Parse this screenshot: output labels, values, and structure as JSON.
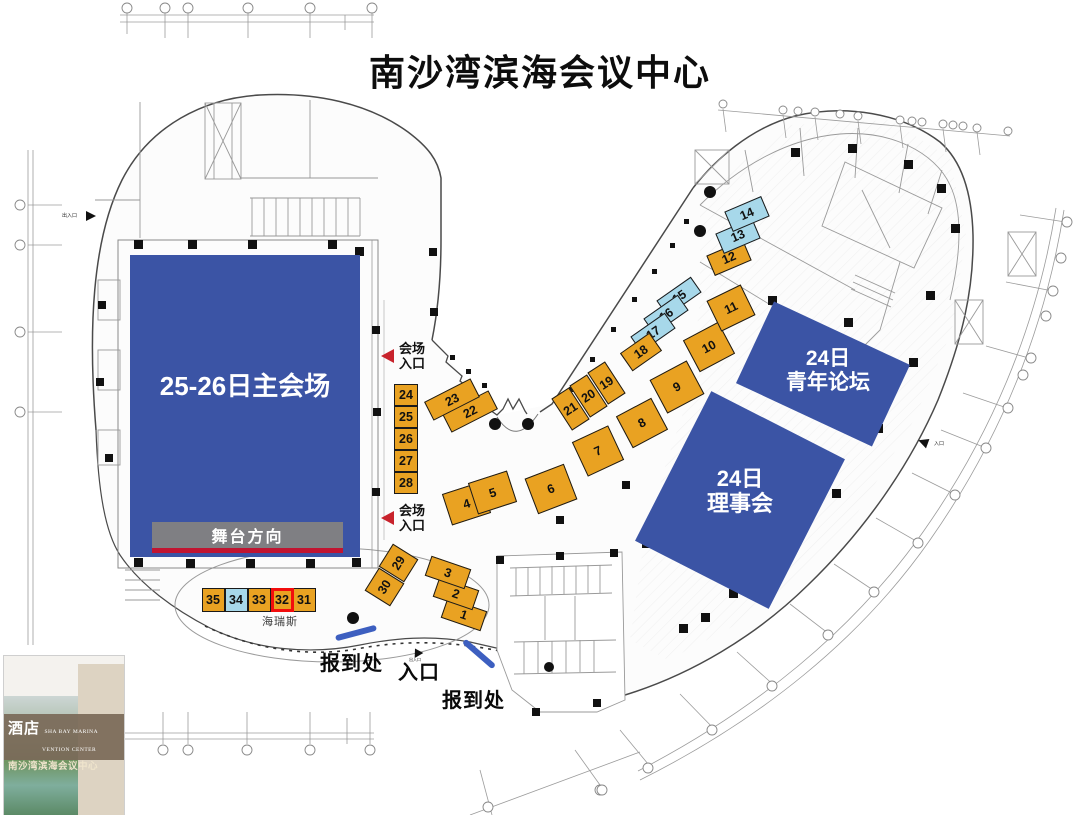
{
  "title": "南沙湾滨海会议中心",
  "colors": {
    "hall_blue": "#3B54A5",
    "booth_orange": "#E9A222",
    "booth_lightblue": "#A7D8EA",
    "stage_gray": "#7F7F83",
    "stage_red": "#C11431",
    "marker_red": "#C8232C",
    "highlight_red": "#F20D0D",
    "desk_blue": "#3D5FC0"
  },
  "halls": {
    "main": {
      "label": "25-26日主会场"
    },
    "stage": {
      "label": "舞台方向"
    },
    "youth_forum": {
      "line1": "24日",
      "line2": "青年论坛"
    },
    "council": {
      "line1": "24日",
      "line2": "理事会"
    }
  },
  "entrances": {
    "hall_entrance_upper": {
      "line1": "会场",
      "line2": "入口"
    },
    "hall_entrance_lower": {
      "line1": "会场",
      "line2": "入口"
    },
    "registration_left": "报到处",
    "main_entrance": "入口",
    "registration_right": "报到处",
    "west_service_entrance": "出入口",
    "east_service_entrance": "入口",
    "gate_marker": "出入口"
  },
  "annotations": {
    "booth32_note": "海瑞斯"
  },
  "booths": [
    {
      "label": "1",
      "color": "orange"
    },
    {
      "label": "2",
      "color": "orange"
    },
    {
      "label": "3",
      "color": "orange"
    },
    {
      "label": "4",
      "color": "orange"
    },
    {
      "label": "5",
      "color": "orange"
    },
    {
      "label": "6",
      "color": "orange"
    },
    {
      "label": "7",
      "color": "orange"
    },
    {
      "label": "8",
      "color": "orange"
    },
    {
      "label": "9",
      "color": "orange"
    },
    {
      "label": "10",
      "color": "orange"
    },
    {
      "label": "11",
      "color": "orange"
    },
    {
      "label": "12",
      "color": "orange"
    },
    {
      "label": "13",
      "color": "lightblue"
    },
    {
      "label": "14",
      "color": "lightblue"
    },
    {
      "label": "15",
      "color": "lightblue"
    },
    {
      "label": "16",
      "color": "lightblue"
    },
    {
      "label": "17",
      "color": "lightblue"
    },
    {
      "label": "18",
      "color": "orange"
    },
    {
      "label": "19",
      "color": "orange"
    },
    {
      "label": "20",
      "color": "orange"
    },
    {
      "label": "21",
      "color": "orange"
    },
    {
      "label": "22",
      "color": "orange"
    },
    {
      "label": "23",
      "color": "orange"
    },
    {
      "label": "24",
      "color": "orange"
    },
    {
      "label": "25",
      "color": "orange"
    },
    {
      "label": "26",
      "color": "orange"
    },
    {
      "label": "27",
      "color": "orange"
    },
    {
      "label": "28",
      "color": "orange"
    },
    {
      "label": "29",
      "color": "orange"
    },
    {
      "label": "30",
      "color": "orange"
    },
    {
      "label": "31",
      "color": "orange"
    },
    {
      "label": "32",
      "color": "orange",
      "highlight": true
    },
    {
      "label": "33",
      "color": "orange"
    },
    {
      "label": "34",
      "color": "lightblue"
    },
    {
      "label": "35",
      "color": "orange"
    }
  ],
  "brand_card": {
    "cn_partial": "酒店",
    "en_line1": "SHA BAY MARINA",
    "en_line2": "VENTION CENTER",
    "cn_name": "南沙湾滨海会议中心"
  }
}
